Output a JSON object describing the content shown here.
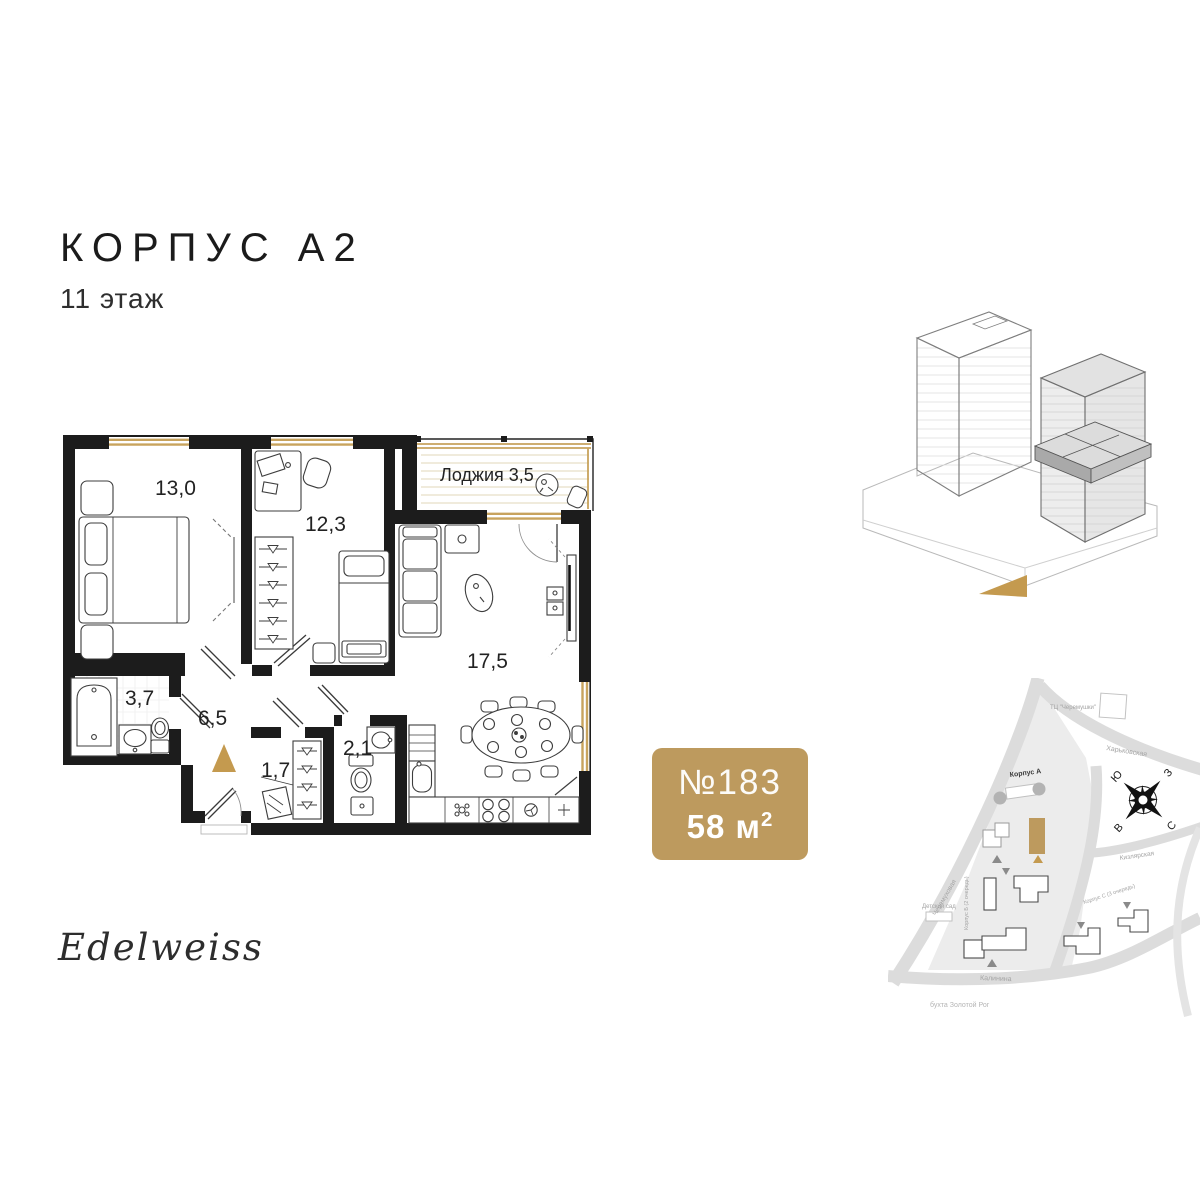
{
  "header": {
    "title": "КОРПУС А2",
    "subtitle": "11 этаж"
  },
  "floor_plan": {
    "loggia_label": "Лоджия 3,5",
    "areas": {
      "bedroom_1": "13,0",
      "bedroom_2": "12,3",
      "kitchen_living": "17,5",
      "hallway": "6,5",
      "bathroom": "3,7",
      "wardrobe": "1,7",
      "wc": "2,1"
    }
  },
  "apartment": {
    "number": "№183",
    "area_value": "58 м",
    "area_exponent": "2"
  },
  "site_map": {
    "labels": {
      "mall": "ТЦ \"Черемушки\"",
      "street_kharkovskaya": "Харьковская",
      "street_cheremukhovaya": "Черемуховая",
      "street_kizlyarskaya": "Кизлярская",
      "street_kalinina": "Калинина",
      "bay": "бухта Золотой Рог",
      "korpus_a": "Корпус А",
      "korpus_b": "Корпус Б (2 очередь)",
      "korpus_c": "Корпус С (3 очередь)",
      "kindergarten": "Детский сад"
    },
    "compass": {
      "south": "Ю",
      "west": "З",
      "east": "В",
      "north": "С"
    }
  },
  "logo": {
    "text": "Edelweiss"
  },
  "colors": {
    "accent_gold": "#bd9a5e",
    "wall": "#1c1c1c"
  }
}
